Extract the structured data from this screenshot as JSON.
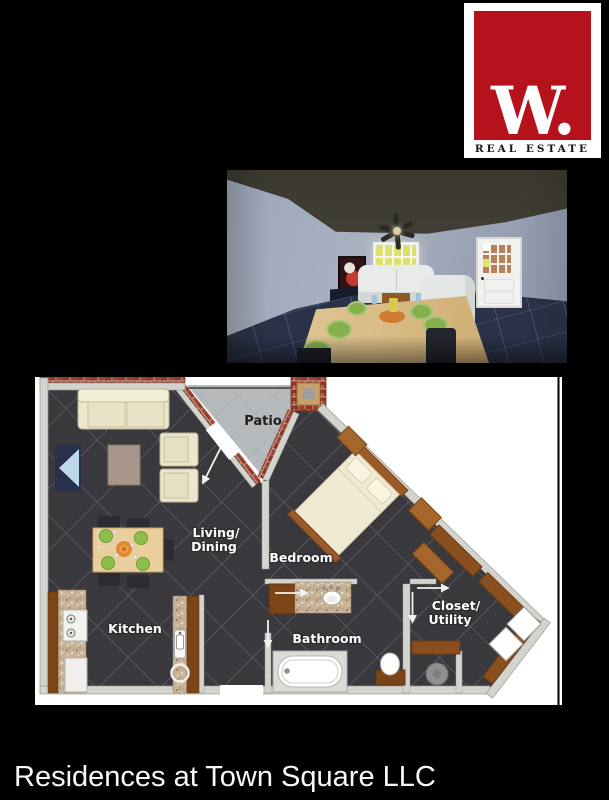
{
  "colors": {
    "background": "#000000",
    "logo_red": "#b5121b",
    "plan_tile": "#39393d",
    "brick": "#9c3a28",
    "render_floor": "#2b3248"
  },
  "logo": {
    "monogram": "W.",
    "tagline": "REAL ESTATE"
  },
  "floorplan": {
    "labels": {
      "patio": "Patio",
      "living_line1": "Living/",
      "living_line2": "Dining",
      "bedroom": "Bedroom",
      "kitchen": "Kitchen",
      "bathroom": "Bathroom",
      "closet_line1": "Closet/",
      "closet_line2": "Utility"
    }
  },
  "footer": {
    "title": "Residences at Town Square LLC"
  }
}
